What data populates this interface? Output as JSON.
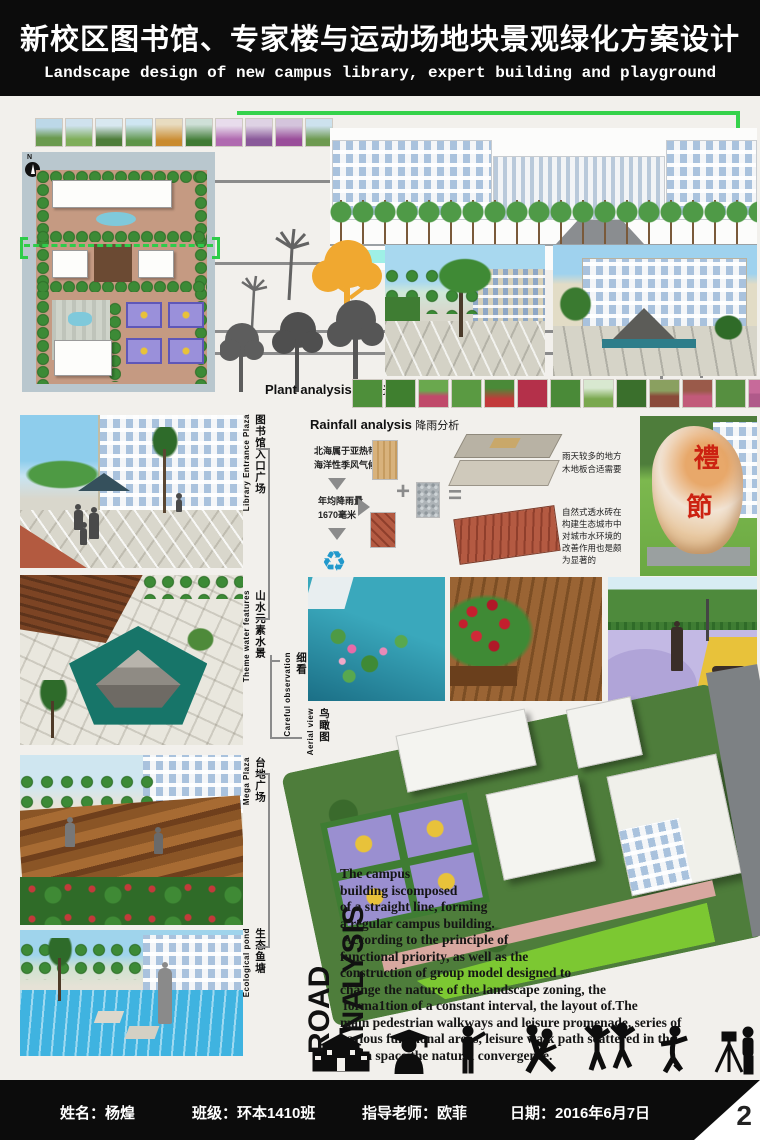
{
  "header": {
    "title_zh": "新校区图书馆、专家楼与运动场地块景观绿化方案设计",
    "title_en": "Landscape design of new campus library, expert building and playground"
  },
  "plan": {
    "north": "N"
  },
  "plant_analysis": {
    "en": "Plant analysis",
    "zh": "植栽分析"
  },
  "rainfall": {
    "en": "Rainfall analysis",
    "zh": "降雨分析",
    "climate": [
      "北海属于亚热带",
      "海洋性季风气候"
    ],
    "amount": [
      "年均降雨量",
      "1670毫米"
    ],
    "plus": "+",
    "equals": "=",
    "note_wood": [
      "雨天较多的地方",
      "木地板合适需要"
    ],
    "note_brick": [
      "自然式透水砖在",
      "构建生态城市中",
      "对城市水环境的",
      "改善作用也是颇",
      "为显著的"
    ]
  },
  "stone": {
    "char1": "禮",
    "char2": "節"
  },
  "labels": {
    "library": {
      "en": "Library Entrance Plaza",
      "zh": "图书馆入口广场"
    },
    "water": {
      "en": "Theme water features",
      "zh": "山水元素水景"
    },
    "observe": {
      "en": "Careful observation",
      "zh": "细看"
    },
    "aerial": {
      "en": "Aerial view",
      "zh": "鸟瞰图"
    },
    "mega": {
      "en": "Mega Plaza",
      "zh": "台地广场"
    },
    "pond": {
      "en": "Ecological pond",
      "zh": "生态鱼塘"
    }
  },
  "road_analysis": {
    "title": "ROAD ANALYSIS",
    "lines": [
      "The campus",
      "building iscomposed",
      "of a straight line, forming",
      "a regular campus building.",
      " According to the principle of",
      "functional priority, as well as the",
      "construction of group model designed to",
      "change the nature of the landscape zoning, the",
      " forma1tion of a constant interval, the layout of.The",
      "main pedestrian walkways and leisure promenade, series of",
      "various functional areas, leisure walk path scattered in the",
      "green space the natural convergence."
    ]
  },
  "icons": [
    "school-icon",
    "graduate-icon",
    "lecturer-icon",
    "dancing-couple-icon",
    "celebration-icon",
    "dancer-icon",
    "surveyor-icon"
  ],
  "footer": {
    "name": "姓名：杨煌",
    "class": "班级：环本1410班",
    "advisor": "指导老师：欧菲",
    "date": "日期：2016年6月7日",
    "page": "2"
  },
  "colors": {
    "accent_green": "#35d24b",
    "water_teal": "#177569",
    "brick_red": "#a5503c",
    "header_bg": "#0c0c0c"
  }
}
